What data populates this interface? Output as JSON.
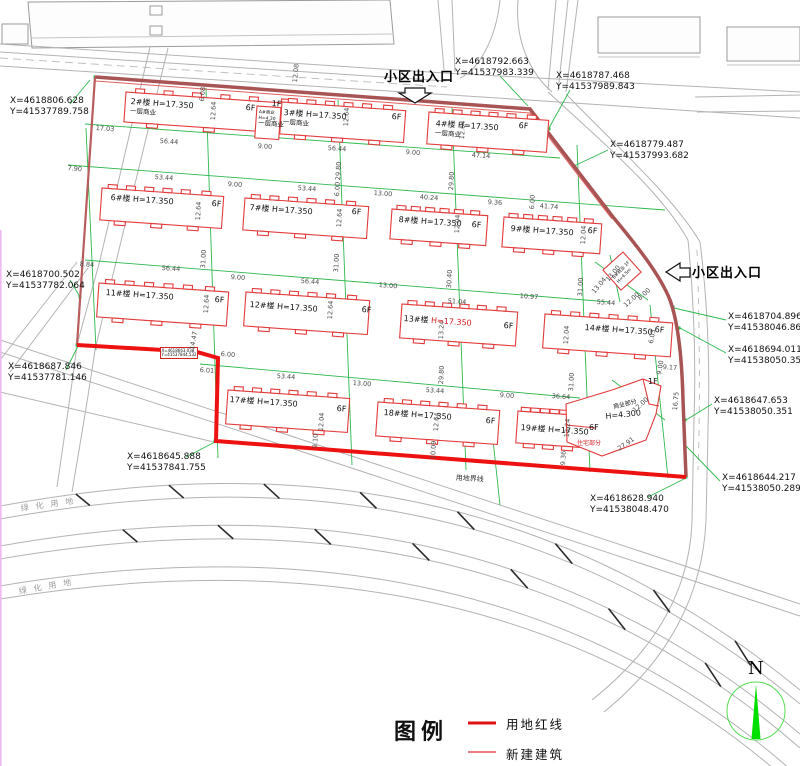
{
  "plan": {
    "entrance_top": "小区出入口",
    "entrance_right": "小区出入口",
    "boundary_label": "用地界线",
    "green_space_labels": [
      "绿化用地",
      "绿化用地"
    ],
    "north_label": "N"
  },
  "legend": {
    "title": "图例",
    "items": [
      {
        "label": "用地红线",
        "style": "thick-red-line"
      },
      {
        "label": "新建建筑",
        "style": "thin-red-line"
      }
    ]
  },
  "colors": {
    "red_line": "#e01010",
    "boundary_dark": "#a85454",
    "building_red": "#e23b3b",
    "dim_green": "#2db84d",
    "road_gray": "#b3b3b3",
    "north_green": "#00dd22"
  },
  "coordinates": [
    {
      "x": "X=4618806.628",
      "y": "Y=41537789.758"
    },
    {
      "x": "X=4618792.663",
      "y": "Y=41537983.339"
    },
    {
      "x": "X=4618787.468",
      "y": "Y=41537989.843"
    },
    {
      "x": "X=4618779.487",
      "y": "Y=41537993.682"
    },
    {
      "x": "X=4618704.896",
      "y": "Y=41538046.868"
    },
    {
      "x": "X=4618694.011",
      "y": "Y=41538050.351"
    },
    {
      "x": "X=4618647.653",
      "y": "Y=41538050.351"
    },
    {
      "x": "X=4618644.217",
      "y": "Y=41538050.289"
    },
    {
      "x": "X=4618628.940",
      "y": "Y=41538048.470"
    },
    {
      "x": "X=4618700.502",
      "y": "Y=41537782.064"
    },
    {
      "x": "X=4618687.846",
      "y": "Y=41537781.146"
    },
    {
      "x": "X=4618645.888",
      "y": "Y=41537841.755"
    }
  ],
  "step_coordinate": {
    "x": "X=4618663.038",
    "y": "Y=41537844.532"
  },
  "buildings": [
    {
      "no": "2#楼",
      "h": "H=17.350",
      "floors": "6F",
      "note": "一层商业"
    },
    {
      "no": "A#商业",
      "h": "H=4.30",
      "floors": "1F",
      "note": "一层商业"
    },
    {
      "no": "3#楼",
      "h": "H=17.350",
      "floors": "6F",
      "note": "一层商业"
    },
    {
      "no": "4#楼",
      "h": "H=17.350",
      "floors": "6F",
      "note": "一层商业"
    },
    {
      "no": "6#楼",
      "h": "H=17.350",
      "floors": "6F"
    },
    {
      "no": "7#楼",
      "h": "H=17.350",
      "floors": "6F"
    },
    {
      "no": "8#楼",
      "h": "H=17.350",
      "floors": "6F"
    },
    {
      "no": "9#楼",
      "h": "H=17.350",
      "floors": "6F"
    },
    {
      "no": "B#商业 1F",
      "h": "H=4.5m"
    },
    {
      "no": "11#楼",
      "h": "H=17.350",
      "floors": "6F"
    },
    {
      "no": "12#楼",
      "h": "H=17.350",
      "floors": "6F"
    },
    {
      "no": "13#楼",
      "h": "H=17.350",
      "floors": "6F"
    },
    {
      "no": "14#楼",
      "h": "H=17.350",
      "floors": "6F"
    },
    {
      "no": "17#楼",
      "h": "H=17.350",
      "floors": "6F"
    },
    {
      "no": "18#楼",
      "h": "H=17.350",
      "floors": "6F"
    },
    {
      "no": "19#楼",
      "h": "H=17.350"
    },
    {
      "note": "商业部分",
      "h": "H=4.300",
      "note2": "住宅部分",
      "floors": "6F",
      "floors2": "1F"
    }
  ],
  "dims": [
    "17.03",
    "56.44",
    "9.00",
    "56.44",
    "9.00",
    "47.14",
    "7.90",
    "53.44",
    "9.00",
    "53.44",
    "13.00",
    "40.24",
    "9.36",
    "41.74",
    "8.84",
    "56.44",
    "9.00",
    "56.44",
    "13.00",
    "51.04",
    "10.97",
    "55.44",
    "6.01",
    "53.44",
    "13.00",
    "53.44",
    "9.00",
    "36.64",
    "6.00",
    "9.17",
    "27.91",
    "13.04",
    "12.00",
    "8.00",
    "12.00",
    "12.08",
    "6.08",
    "12.64",
    "12.64",
    "12.64",
    "29.80",
    "29.80",
    "6.00",
    "6.00",
    "12.64",
    "12.64",
    "31.00",
    "31.00",
    "12.04",
    "12.04",
    "30.40",
    "31.00",
    "12.64",
    "12.64",
    "13.24",
    "12.04",
    "14.47",
    "29.80",
    "31.00",
    "12.04",
    "9.10",
    "12.64",
    "10.09",
    "13.24",
    "9.36",
    "16.75",
    "6.03",
    "9.00",
    "13.00"
  ]
}
